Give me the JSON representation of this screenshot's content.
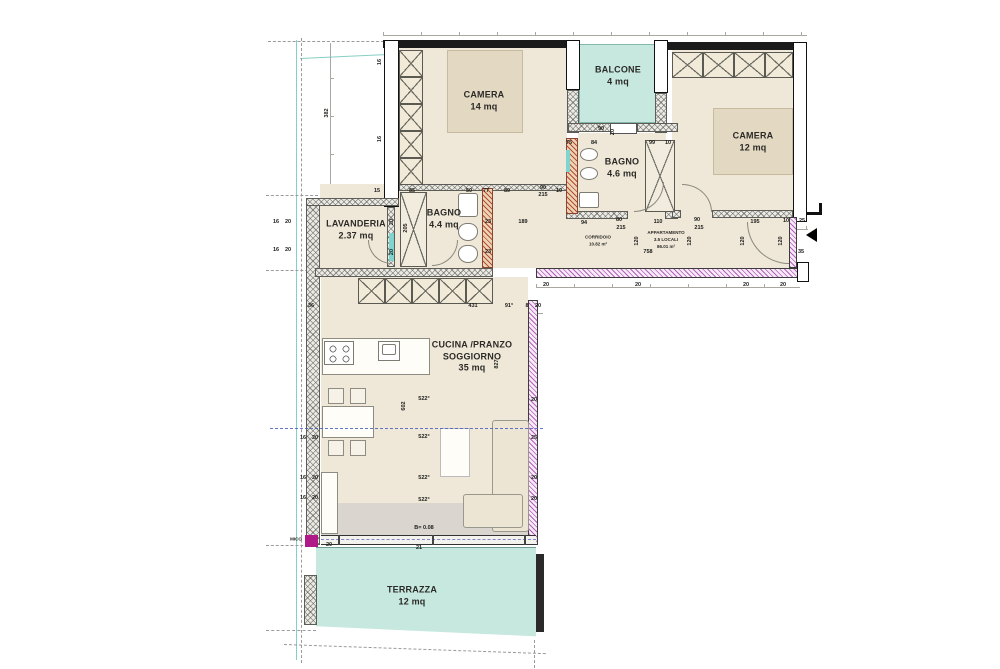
{
  "drawing_type": "apartment floor plan",
  "rooms": {
    "camera14": {
      "name": "CAMERA",
      "area": "14 mq"
    },
    "balcone": {
      "name": "BALCONE",
      "area": "4 mq"
    },
    "camera12": {
      "name": "CAMERA",
      "area": "12 mq"
    },
    "bagno46": {
      "name": "BAGNO",
      "area": "4.6 mq"
    },
    "bagno44": {
      "name": "BAGNO",
      "area": "4.4 mq"
    },
    "lavanderia": {
      "name": "LAVANDERIA",
      "area": "2.37 mq"
    },
    "soggiorno": {
      "name_line1": "CUCINA /PRANZO",
      "name_line2": "SOGGIORNO",
      "area": "35 mq"
    },
    "terrazza": {
      "name": "TERRAZZA",
      "area": "12 mq"
    },
    "corridoio": {
      "name": "CORRIDOIO",
      "area": "10.82 m²"
    },
    "appartamento": {
      "line1": "APPARTAMENTO",
      "line2": "3.5 LOCALI",
      "line3": "86.01 m²"
    }
  },
  "colors": {
    "room_fill": "#efe8d8",
    "bed_fill": "#e3d8c1",
    "balcony_terrace": "#c7e8df",
    "wall_black": "#1b1b1b",
    "wall_purple_hatch": "#a848b2",
    "wall_red_hatch": "#ac3e28",
    "section_line_blue": "#4a5fc0",
    "boundary_teal": "#86cfc4",
    "threshold_magenta": "#b01a86"
  },
  "dims": [
    {
      "t": "382"
    },
    {
      "t": "16"
    },
    {
      "t": "16"
    },
    {
      "t": "15"
    },
    {
      "t": "85"
    },
    {
      "t": "50"
    },
    {
      "t": "77"
    },
    {
      "t": "89"
    },
    {
      "t": "90"
    },
    {
      "t": "215"
    },
    {
      "t": "10"
    },
    {
      "t": "75"
    },
    {
      "t": "84"
    },
    {
      "t": "99"
    },
    {
      "t": "10"
    },
    {
      "t": "90"
    },
    {
      "t": "20"
    },
    {
      "t": "94"
    },
    {
      "t": "80"
    },
    {
      "t": "215"
    },
    {
      "t": "110"
    },
    {
      "t": "90"
    },
    {
      "t": "215"
    },
    {
      "t": "195"
    },
    {
      "t": "10"
    },
    {
      "t": "25"
    },
    {
      "t": "120"
    },
    {
      "t": "120"
    },
    {
      "t": "120"
    },
    {
      "t": "120"
    },
    {
      "t": "758"
    },
    {
      "t": "35"
    },
    {
      "t": "20"
    },
    {
      "t": "20"
    },
    {
      "t": "20"
    },
    {
      "t": "20"
    },
    {
      "t": "36"
    },
    {
      "t": "431"
    },
    {
      "t": "91°"
    },
    {
      "t": "8"
    },
    {
      "t": "20"
    },
    {
      "t": "602"
    },
    {
      "t": "827"
    },
    {
      "t": "522°"
    },
    {
      "t": "522°"
    },
    {
      "t": "522°"
    },
    {
      "t": "522°"
    },
    {
      "t": "20"
    },
    {
      "t": "25"
    },
    {
      "t": "20"
    },
    {
      "t": "20"
    },
    {
      "t": "16"
    },
    {
      "t": "20"
    },
    {
      "t": "16"
    },
    {
      "t": "20"
    },
    {
      "t": "16"
    },
    {
      "t": "20"
    },
    {
      "t": "20"
    },
    {
      "t": "20"
    },
    {
      "t": "23"
    },
    {
      "t": "23"
    },
    {
      "t": "205"
    },
    {
      "t": "189"
    },
    {
      "t": "16"
    },
    {
      "t": "20"
    },
    {
      "t": "16"
    },
    {
      "t": "20"
    },
    {
      "t": "21"
    },
    {
      "t": "20"
    },
    {
      "t": "B= 0.08"
    },
    {
      "t": "MICO"
    }
  ]
}
